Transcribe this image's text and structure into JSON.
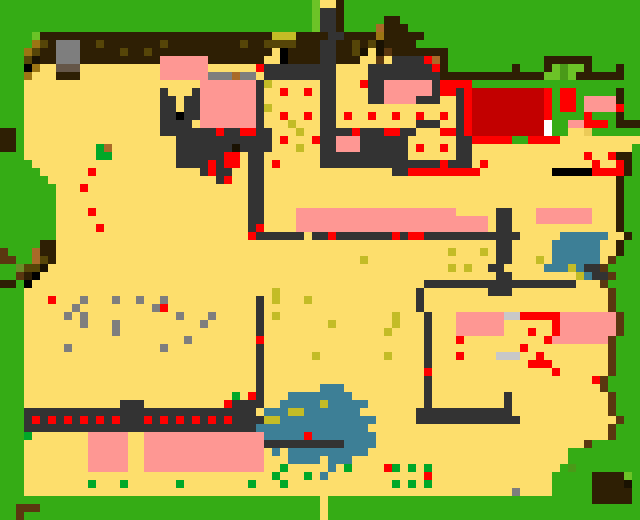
{
  "app": {
    "title": "Pixel Village Map",
    "view": "overhead-tile-map"
  },
  "map": {
    "grid_width": 80,
    "grid_height": 65,
    "cell_size": 8,
    "pixel_width": 640,
    "pixel_height": 520,
    "palette": {
      "G": "#35ac15",
      "L": "#6cc327",
      "g": "#00a828",
      "d": "#4a9a18",
      "m": "#6b8c28",
      "S": "#fdde6c",
      "s": "#eccb58",
      "N": "#fe9793",
      "R": "#fe0000",
      "r": "#c20000",
      "A": "#333333",
      "Y": "#7e7e7e",
      "l": "#c8c8c8",
      "B": "#2e1f04",
      "E": "#5a3710",
      "T": "#655648",
      "C": "#a96a28",
      "o": "#9c7514",
      "O": "#564508",
      "K": "#000000",
      "k": "#1a1202",
      "M": "#c3bc26",
      "U": "#3d7f96",
      "W": "#ffffff"
    },
    "legend": {
      "G": "grass",
      "L": "light-grass",
      "g": "green-marker",
      "d": "leaf-green",
      "m": "moss",
      "S": "sand",
      "s": "dark-sand",
      "N": "pink-roof",
      "R": "red-marker",
      "r": "dark-red-roof",
      "A": "dark-path",
      "Y": "rock-gray",
      "l": "light-gray",
      "B": "dark-brown",
      "E": "earth-brown",
      "T": "taupe",
      "C": "caramel",
      "o": "ochre",
      "O": "olive",
      "K": "black",
      "k": "near-black",
      "M": "khaki",
      "U": "water-teal",
      "W": "white"
    },
    "rows": [
      "GGGGGGGGGGGGGGGGGGGGGGGGGGGGGGGGGGGGGGGLSSBGGGGGGGGGGGGGGGGGGGGGGGGGGGGGGGGGGGG",
      "GGGGGGGGGGGGGGGGGGGGGGGGGGGGGGGGGGGGGGGLAABGGGGGGGGGGGGGGGGGGGGGGGGGGGGGGGGGGGG",
      "GGGGGGGGGGGGGGGGGGGGGGGGGGGGGGGGGGGGGGGLAABGGGGGBBGGGGGGGGGGGGGGGGGGGGGGGGGGGGG",
      "GGGGGGGGGGGGGGGGGGGGGGGGGGGGGGGGGGGGGGGLAABGGGGCBBBGGGGGGGGGGGGGGGGGGGGGGGGGGGG",
      "GGGGLBBBBBBBBBBBBBBBBBBBBBBBBBBBBBMMMBBBBAABBBBoBBBBBGGGGGGGGGGGGGGGGGGGGGGGGGG",
      "GGGGoOBYYYBBOBBBBBBBOBBBBBBBBBOBBOOOOBBBAABBOBOkBBBBGGGGGGGGGGGGGGGGGGGGGGGGGGG",
      "GGGoOBBYYYBBBBBOBBOBBBBBBBBBBBBBBBSKBBBBAABBOkSkEBBBBBBBGGGGGGGGGGGGGGGGGGGGGGG",
      "GGGOkBBYYYBBBBBBBBBBNNNNNNBBBBBBBSSKBBBBAABBBSSESAAAARCBGGGGGGGGGGGGBBBBBBGGGGGG",
      "GGGKoSSTTTSSSSSSSSSSNNNNNNSSSSSSRAAAAAAAAASSSSAAAAAAAARBGGGGGGGGBGGGBLdLLBGGGBGG",
      "GGGoSSSBBBSSSSSSSSSSNNNNNNYYYCYYSAAAAAAAAASSSSAAAAAAAAABBBBBBBBBBBBBLLdLBBBBBBG",
      "GGGSSSSSSSSSSSSSSSSSSSSSSNNNNNNNAMSSSSSSAASSSRAANNNNNNARRRRGGGGGGGGGGGGGGGGGGGG",
      "GGGSSSSSSSSSSSSSSSSSASSSANNNNNNNASSRSSRSAASSSSAANNNNNNARRARrrrrrrrrrRGRRGGGGGBGG",
      "GGGSSSSSSSSSSSSSSSSSAASAANNNNNNNASSSSSSSAASSSSAANNNNAAASSARrrrrrrrrrRGRRGNNNNBGG",
      "GGGSSSSSSSSSSSSSSSSSAASAANNNNNNNAMSSSSSSAASSSSSSSSSSSSSSSARrrrrrrrrrRGRRGNNNNRGG",
      "GGGSSSSSSSSSSSSSSSSSAAKAANNNNNNNASSRSSRSAASRSSRSSRSSRSSRSARrrrrrrrrrRGGGGRGGGBGG",
      "GGGSSSSSSSSSSSSSSSSSAAAASNNNNNNNASSSMSSSAASSSSSSSSSSAAASSARrrrrrrrrrWGGNNRRRGBBB",
      "BBGSSSSSSSSSSSSSSSSSAAAAAAARAARRAASSSMSSAAAARAAARRAASSSRRARrrrrrrrrrWGGSSsGGGGGG",
      "BBGSSSSSSSSSSSSSSSSSSSAAAAAAAAAAAASRSSSRAANNNAAAAAASSSSSSAARRRRRGGRRRRSSSSSSSSSS",
      "BBGSSSSSSSSSgCSSSSSSSSAAAAAAAkAAAASSSMSSAANNNAAAAAASRSSRSAASSSSSSSSSSSSSSSSSSSS",
      "GGGSSSSSSSSSggSSSSSSSSAAAAAARRSAASSSSSSSAAAAAAAAAAASSSSSSAASSSSSSSSSSSSSSRSSRBB",
      "GGGGSSSSSSSSSSSSSSSSSSAAAARARRSAASRSSSSSAAAAAAAAAAAAAAARAAASRSSSSSSSSSSSSSRSSRBG",
      "GGGGGSSSSSSRSSSSSSSSSSSSSARAASSAASSSSSSSSSSSSSSSSAARRRRRRRRRSSSSSSSSSKKKKKRRRRBG",
      "GGGGGGSSSSSSSSSSSSSSSSSSSSSARSSAASSSSSSSSSSSSSSSSSSSSSSSSSSSSSSSSSSSSSSSSSSSSBG",
      "GGGGGGGSSSRSSSSSSSSSSSSSSSSSSSSAASSSSSSSSSSSSSSSSSSSSSSSSSSSSSSSSSSSSSSSSSSSSBG",
      "GGGGGGGSSSSSSSSSSSSSSSSSSSSSSSSAASSSSSSSSSSSSSSSSSSSSSSSSSSSSSSSSSSSSSSSSSSSSBG",
      "GGGGGGGSSSSSSSSSSSSSSSSSSSSSSSSAASSSSSSSSSSSSSSSSSSSSSSSSSSSSSSSSSSSSSSSSSSSSBG",
      "GGGGGGGSSSSRSSSSSSSSSSSSSSSSSSSAASSSSNNNNNNNNNNNNNNNNNNNNSSSSSAASSSNNNNNNNSSSBG",
      "GGGGGGGSSSSSSSSSSSSSSSSSSSSSSSSAASSSSNNNNNNNNNNNNNNNNNNNNNNNNSAASSSNNNNNNNSSSBG",
      "GGGGGGGSSSSSRSSSSSSSSSSSSSSSSSSARSSSSNNNNNNNNNNNNNNNNNNNNNNNNSAASSSSSSSSSSSSSBG",
      "GGGGGGGSSSSSSSSSSSSSSSSSSSSSSSSRAAAAAASAARAAAAAAARARRAAAAAAAAAAAASSSSSUUUUUUSSBG",
      "GGGGGBBSSSSSSSSSSSSSSSSSSSSSSSSSSSSSSSSSSSSSSSSSSSSSSSSSSSSSSSAASSSSSUUUUUUSSBG",
      "EGGGCBBSSSSSSSSSSSSSSSSSSSSSSSSSSSSSSSSSSSSSSSSSSSSSSSSSMSSSMSAASSSSSUUUUUUSSBG",
      "EEGGCOBSSSSSSSSSSSSSSSSSSSSSSSSSSSSSSSSSSSSSSMSSSSSSSSSSSSSSSSAASSSMSUUUUUUSEGG",
      "GGmOOkSSSSSSSSSSSSSSSSSSSSSSSSSSSSSSSSSSSSSSSSSSSSSSSSSSMSMSSAASSSSSUUUMUAAEGG",
      "GGEBKSSSSSSSSSSSSSSSSSSSSSSSSSSSSSSSSSSSSSSSSSSSSSSSSSSSSSSSSSAASSSSSSSSMUAAEGG",
      "BBGKSSSSSSSSSSSSSSSSSSSSSSSSSSSSSSSSSSSSSSSSSSSSSSSSSAAAAAAAAAAAAAAAAAAASSSEGG",
      "GGGSSSSSSSSSSSSSSSSSSSSSSSSSSSSSSSMSSSSSSSSSSSSSSSSSASSSSSSSSAAASSSSSSSSSSSSEGG",
      "GGGSSSRSSSYSSSYSSYSSYSSSSSSSSSSSASMSSSMSSSSSSSSSSSSSASSSSSSSSSSSSSSSSSSSSSSSEGG",
      "GGGSSSSSSYSSSSSSSSSYRSSSSSSSSSSSASSSSSSSSSSSSSSSSSSSASSSSSSSSSSSSSSSSSSSSSSSEGG",
      "GGGSSSSSYSYSSSSSSSSSSSYSSSYSSSSSASMSSSSSSSSSSSSSSMSSSASSSNNNNNNllRRRRRNNNNNNNEGG",
      "GGGSSSSSSSYSSSYSSSSSSSSSSYSSSSSSASSSSSSSSMSSSSSSSMSSSASSSNNNNNNSSSSSSRNNNNNNNEGG",
      "GGGSSSSSSSSSSSYSSSSSSSSSSSSSSSSSASSSSSSSSSSSSSSSMSSSSASSSNNNNNNSSSRSSRNNNNNNNEGG",
      "GGGSSSSSSSSSSSSSSSSSSSSYSSSSSSSSRSSSSSSSSSSSSSSSSSSSSASSSRSSSSSSSSSSRNNNNNNNEGG",
      "GGGSSSSSYSSSSSSSSSSSYSSSSSSSSSSSASSSSSSSSSSSSSSSSSSSSASSSSSSSSSSSRSSSSSSSSSSEGG",
      "GGGSSSSSSSSSSSSSSSSSSSSSSSSSSSSSASSSSSSMSSSSSSSSMSSSSASSSRSSSSlllSSRSSSSSSSSEGG",
      "GGGSSSSSSSSSSSSSSSSSSSSSSSSSSSSSASSSSSSSSSSSSSSSSSSSSASSSSSSSSSSSSRRRSSSSSSSEGG",
      "GGGSSSSSSSSSSSSSSSSSSSSSSSSSSSSSASSSSSSSSSSSSSSSSSSSSRSSSSSSSSSSSSSSSRSSSSSSEGG",
      "GGGSSSSSSSSSSSSSSSSSSSSSSSSSSSSSASSSSSSSSSSSSSSSSSSSSASSSSSSSSSSSSSSSSSSSSREGG",
      "GGGSSSSSSSSSSSSSSSSSSSSSSSSSSSSSASSSSSSSUUUSSSSSSSSSSASSSSSSSSSSSSSSSSSSSSSEGG",
      "GGGSSSSSSSSSSSSSSSSSSSSSSSSSSgSRASSSUUUUUUUUSSSSSSSSSASSSSSSSSSASSSSSSSSSSSSEGG",
      "GGGSSSSSSSSSSSSAAASSSSSSSSSSRAAAASSUUUUUMUUUUUSSSSSSSASSSSSSSSSASSSSSSSSSSSSEGG",
      "GGGAAAAAAAAAAAAAAAAAAAAAAAAAAAAASUUUMMUUUUUUUSSSSSSSAAAAAAAAAAAASSSSSSSSSSSSEGG",
      "GGGARARARARARARAAARARARARARARAAAAMMUUUUUUUUUUUUSSSSSAAAAAAAAAAAAASSSSSSSSSSSSEGG",
      "GGGAAAAAAAAAAAAAAAAAAAAAAAAAAAAAUUUUUUUUUUUUUUSSSSSSSSSSSSSSSSSSSSSSSSSSSSSSEGG",
      "GGGgSSSSSSSNNNNNSSNNNNNNNNNNNNNNNUUUUURUUUUUUUUSSSSSSSSSSSSSSSSSSSSSSSSSSSSSEGG",
      "GGGSSSSSSSSNNNNNSSNNNNNNNNNNNNNNNAAAAAAAAAAUUUUSSSSSSSSSSSSSSSSSSSSSSSSSSEGGGGG",
      "GGGSSSSSSSSNNNNNSSNNNNNNNNNNNNNNNSUSUUUUUUUUUUSSSSSSSSSSSSSSSSSSSSSSSSSGGGGGGGGG",
      "GGGSSSSSSSSNNNNNSSNNNNNNNNNNNNNNNSSSUUUUSUUUSSSSSSSSSSSSSSSSSSSSSSSSSSSGGGGGGGGG",
      "GGGSSSSSSSSNNNNNSSNNNNNNNNNNNNNNNSSgSSSSSUSgSSSSRgSgSgSSSSSSSSSSSSSSSSGdGGGGGGGG",
      "GGGSSSSSSSSSSSSSSSSSSSSSSSSSSSSSSSgSSSgSUSSSSSSSSSSSSRSSSSSSSSSSSSSSSGGGGGBBBBL",
      "GGGSSSSSSSSgSSSgSSSSSSgSSSSSSSSgSSSgSSSSSSSSSSSSSgSgSgSSSSSSSSSSSSSSSGGGGGBBBBk",
      "GGGSSSSSSSSSSSSSSSSSSSSSSSSSSSSSSSSSSSSSSSSSSSSSSSSSSSSSSSSSSSSSYSSSSGGGGGBBBBB",
      "GGGGGGGGGGGGGGGGGGGGGGGGGGGGGGGGGGGGGGGGSGGGGGGGGGGGGGGGGGGGGGGGGGGGGGGGGGBBBBB",
      "GGEEEGGGGGGGGGGGGGGGGGGGGGGGGGGGGGGGGGGGSGGGGGGGGGGGGGGGGGGGGGGGGGGGGGGGGGGGGGGGUUBBBBB",
      "GGEGGGGGGGGGGGGGGGGGGGGGGGGGGGGGGGGGGGGGSGGGGGGGGGGGGGGGGGGGGGGGGGGGGGGGGGGGGGGGUUSSBBB"
    ]
  }
}
